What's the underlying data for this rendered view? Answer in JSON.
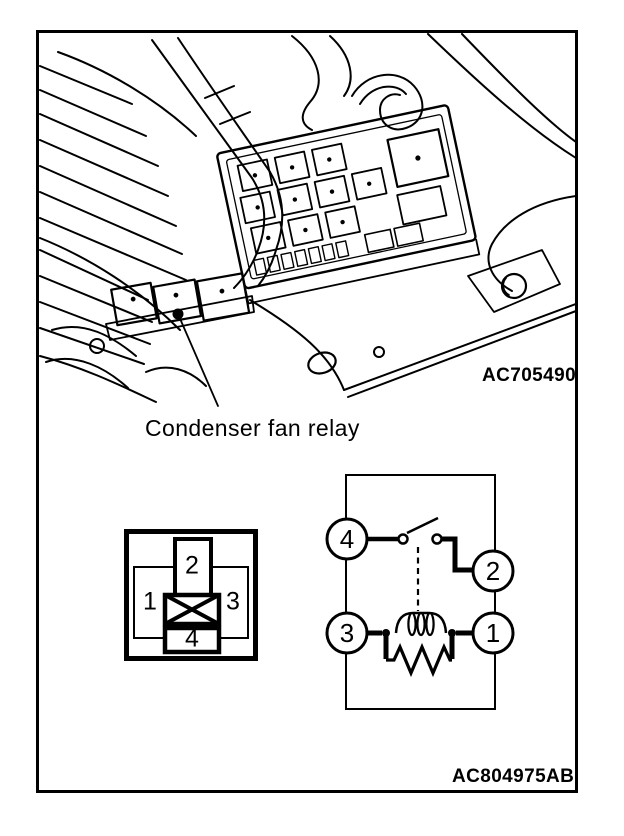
{
  "colors": {
    "ink": "#000000",
    "paper": "#ffffff"
  },
  "location_figure": {
    "callout_label": "Condenser fan relay",
    "figure_code": "AC705490"
  },
  "connector_pinout": {
    "terminal_top": "2",
    "terminal_left": "1",
    "terminal_right": "3",
    "terminal_bottom": "4"
  },
  "circuit_schematic": {
    "terminal_top_left": "4",
    "terminal_top_right": "2",
    "terminal_bottom_left": "3",
    "terminal_bottom_right": "1"
  },
  "footer": {
    "figure_code": "AC804975AB"
  }
}
